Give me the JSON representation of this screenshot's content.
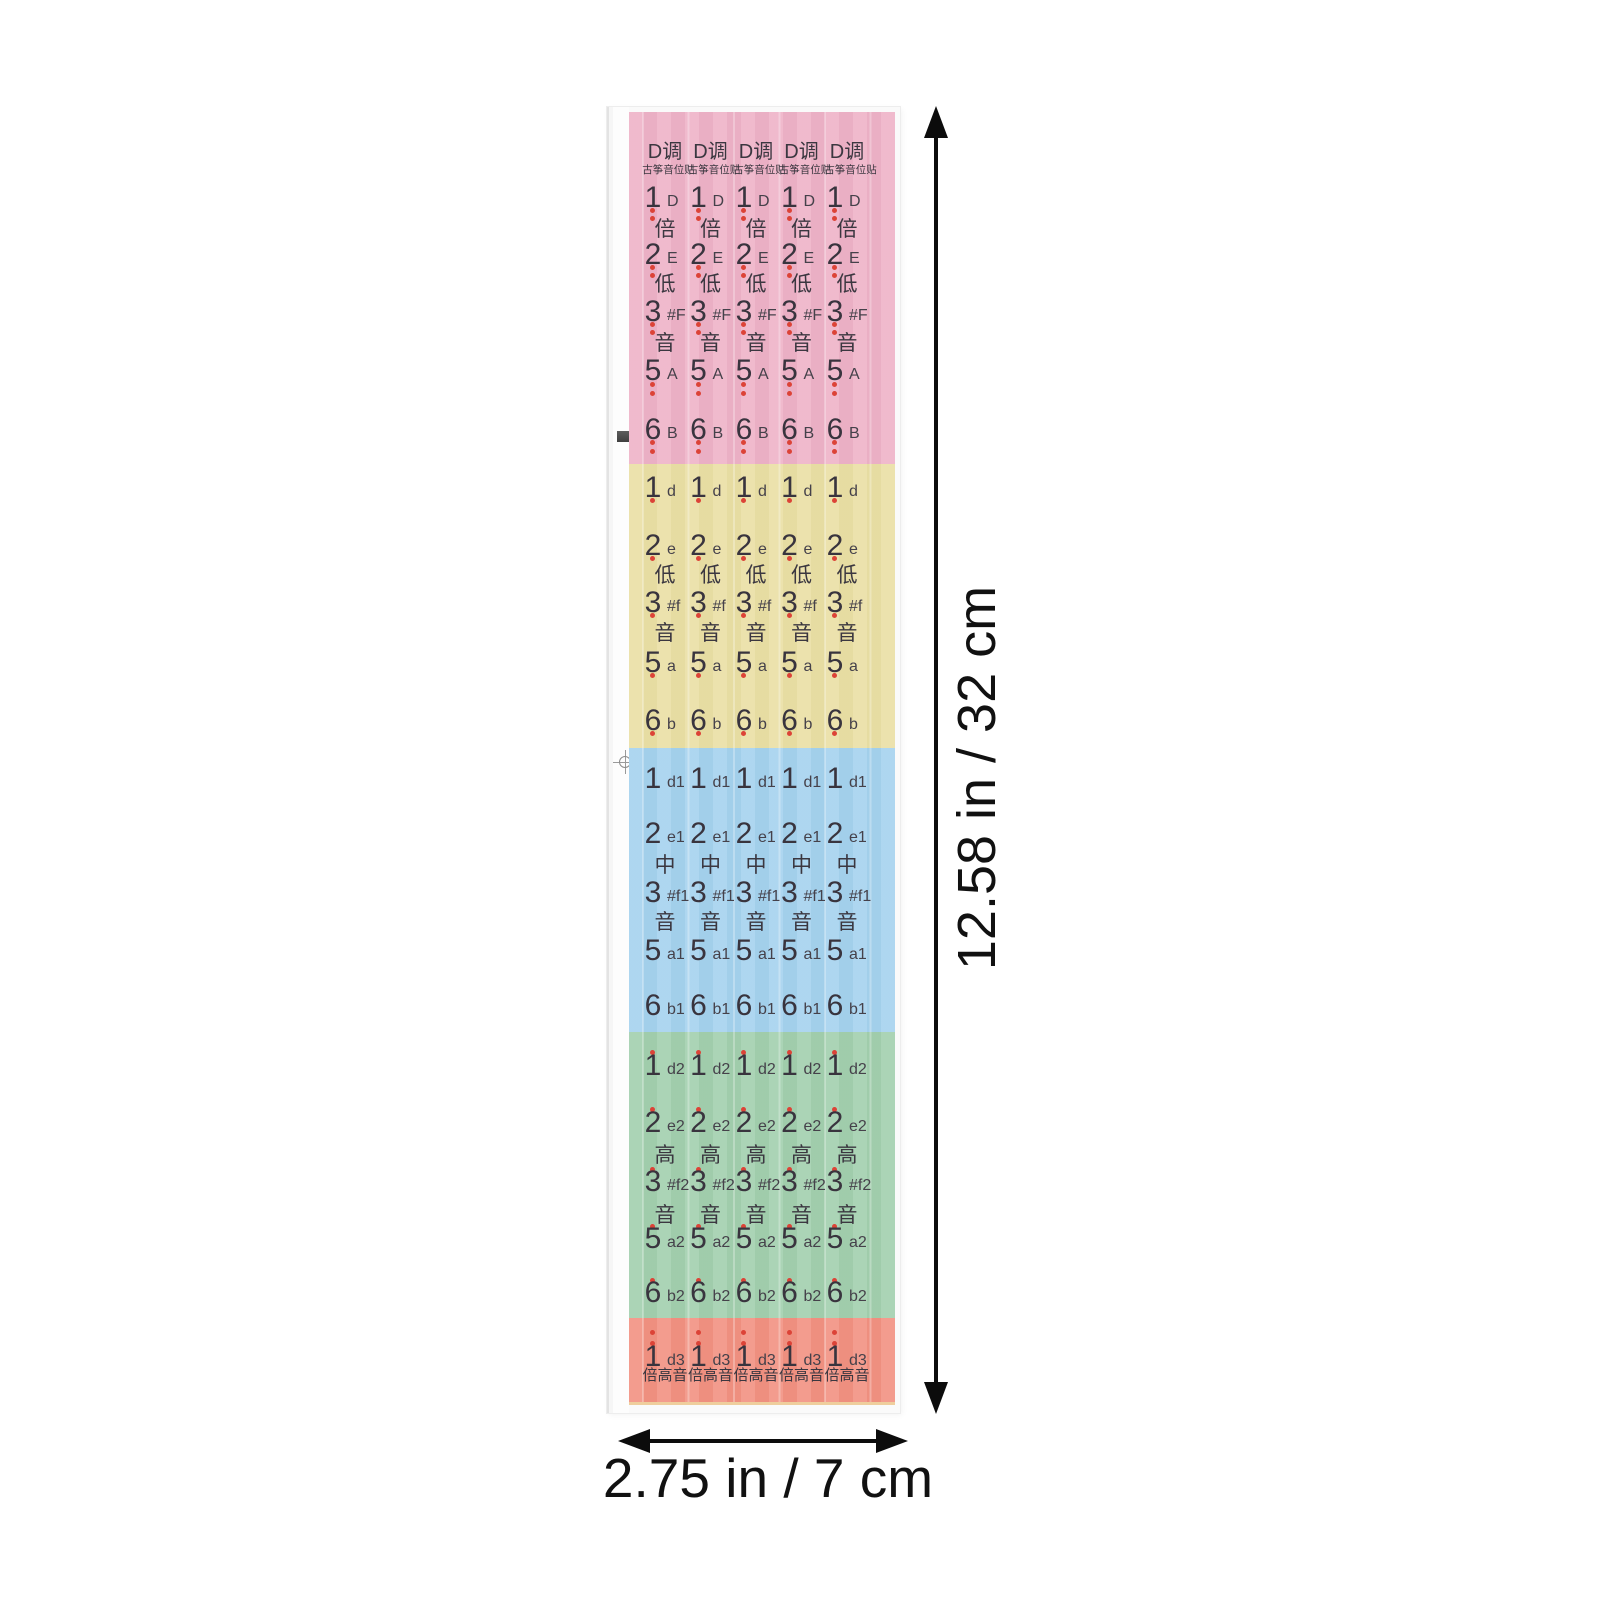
{
  "product": {
    "key_header": "D调",
    "sheet_subtitle": "古筝音位贴"
  },
  "sheet": {
    "columns": 5,
    "sections": [
      {
        "id": "double-low-octave",
        "octave_name": "倍低音",
        "color": "#eeb2c7",
        "height": 352,
        "rows": [
          {
            "t": "header",
            "y": 40,
            "text": "D调"
          },
          {
            "t": "sub",
            "y": 58,
            "text": "古筝音位贴"
          },
          {
            "t": "note",
            "y": 86,
            "num": "1",
            "name": "D"
          },
          {
            "t": "dot",
            "y": 98
          },
          {
            "t": "dot",
            "y": 106
          },
          {
            "t": "kanji",
            "y": 118,
            "text": "倍"
          },
          {
            "t": "note",
            "y": 143,
            "num": "2",
            "name": "E"
          },
          {
            "t": "dot",
            "y": 155
          },
          {
            "t": "dot",
            "y": 163
          },
          {
            "t": "kanji",
            "y": 173,
            "text": "低"
          },
          {
            "t": "note",
            "y": 200,
            "num": "3",
            "name": "#F"
          },
          {
            "t": "dot",
            "y": 212
          },
          {
            "t": "dot",
            "y": 220
          },
          {
            "t": "kanji",
            "y": 232,
            "text": "音"
          },
          {
            "t": "note",
            "y": 259,
            "num": "5",
            "name": "A"
          },
          {
            "t": "dot",
            "y": 272
          },
          {
            "t": "dot",
            "y": 281
          },
          {
            "t": "note",
            "y": 318,
            "num": "6",
            "name": "B"
          },
          {
            "t": "dot",
            "y": 330
          },
          {
            "t": "dot",
            "y": 339
          }
        ]
      },
      {
        "id": "low-octave",
        "octave_name": "低音",
        "color": "#eadfa4",
        "height": 284,
        "rows": [
          {
            "t": "note",
            "y": 24,
            "num": "1",
            "name": "d"
          },
          {
            "t": "dot",
            "y": 36
          },
          {
            "t": "note",
            "y": 82,
            "num": "2",
            "name": "e"
          },
          {
            "t": "dot",
            "y": 94
          },
          {
            "t": "kanji",
            "y": 112,
            "text": "低"
          },
          {
            "t": "note",
            "y": 139,
            "num": "3",
            "name": "#f"
          },
          {
            "t": "dot",
            "y": 151
          },
          {
            "t": "kanji",
            "y": 170,
            "text": "音"
          },
          {
            "t": "note",
            "y": 199,
            "num": "5",
            "name": "a"
          },
          {
            "t": "dot",
            "y": 211
          },
          {
            "t": "note",
            "y": 257,
            "num": "6",
            "name": "b"
          },
          {
            "t": "dot",
            "y": 269
          }
        ]
      },
      {
        "id": "middle-octave",
        "octave_name": "中音",
        "color": "#a5d2ee",
        "height": 284,
        "rows": [
          {
            "t": "note",
            "y": 31,
            "num": "1",
            "name": "d1"
          },
          {
            "t": "note",
            "y": 86,
            "num": "2",
            "name": "e1"
          },
          {
            "t": "kanji",
            "y": 118,
            "text": "中"
          },
          {
            "t": "note",
            "y": 145,
            "num": "3",
            "name": "#f1"
          },
          {
            "t": "kanji",
            "y": 175,
            "text": "音"
          },
          {
            "t": "note",
            "y": 203,
            "num": "5",
            "name": "a1"
          },
          {
            "t": "note",
            "y": 258,
            "num": "6",
            "name": "b1"
          }
        ]
      },
      {
        "id": "high-octave",
        "octave_name": "高音",
        "color": "#a2cfae",
        "height": 286,
        "rows": [
          {
            "t": "dot",
            "y": 20
          },
          {
            "t": "note",
            "y": 34,
            "num": "1",
            "name": "d2"
          },
          {
            "t": "dot",
            "y": 77
          },
          {
            "t": "note",
            "y": 91,
            "num": "2",
            "name": "e2"
          },
          {
            "t": "kanji",
            "y": 124,
            "text": "高"
          },
          {
            "t": "dot",
            "y": 137
          },
          {
            "t": "note",
            "y": 150,
            "num": "3",
            "name": "#f2"
          },
          {
            "t": "kanji",
            "y": 184,
            "text": "音"
          },
          {
            "t": "dot",
            "y": 194
          },
          {
            "t": "note",
            "y": 207,
            "num": "5",
            "name": "a2"
          },
          {
            "t": "dot",
            "y": 248
          },
          {
            "t": "note",
            "y": 261,
            "num": "6",
            "name": "b2"
          }
        ]
      },
      {
        "id": "double-high-octave",
        "octave_name": "倍高音",
        "color": "#f29181",
        "height": 84,
        "rows": [
          {
            "t": "dot",
            "y": 14
          },
          {
            "t": "dot",
            "y": 25
          },
          {
            "t": "note",
            "y": 39,
            "num": "1",
            "name": "d3"
          },
          {
            "t": "footer",
            "y": 58,
            "text": "倍高音"
          }
        ]
      }
    ]
  },
  "annotations": {
    "height_label": "12.58 in / 32 cm",
    "width_label": "2.75 in / 7 cm"
  },
  "colors": {
    "dot": "#dc4337",
    "ink": "#3b3740",
    "dimension_line": "#0c0c0c",
    "backing_paper": "#fafafa"
  }
}
